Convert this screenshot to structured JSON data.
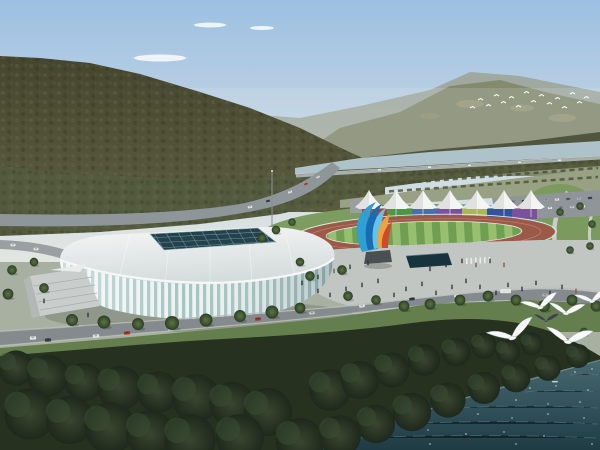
{
  "scene": {
    "title": "Aerial rendering of a riverside sports complex",
    "time_of_day": "day",
    "elements": [
      "forested mountain",
      "distant hazy ridge",
      "river",
      "orchard tree band",
      "athletics track",
      "rainbow panel grandstand wall",
      "white canopy tents",
      "parking lot",
      "ribbon flame sculpture",
      "glass lattice stadium",
      "reflecting pool",
      "plaza with pedestrians",
      "tree-lined boulevard",
      "dense riverfront forest",
      "dark green water",
      "white birds"
    ]
  },
  "colors": {
    "sky_top": "#9cc0e2",
    "sky_mid": "#c6d6e4",
    "sky_horizon": "#e3e6e1",
    "far_ridge": "#9aa08e",
    "near_ridge": "#848a6e",
    "hill_top": "#45462f",
    "hill_bottom": "#5b5c3f",
    "tree_band": "#545a3e",
    "orchard_ground": "#98a183",
    "river": "#adc2c9",
    "lawn": "#7d9c60",
    "lawn_right": "#7a9a5e",
    "track": "#9c5948",
    "field_light": "#98bf70",
    "field_dark": "#6f9f52",
    "tent": "#f3f5f3",
    "parking": "#8f9598",
    "road": "#848a8d",
    "plaza": "#c2c6c3",
    "pool": "#17333c",
    "skylight": "#24424c",
    "stadium_glass": "#a3c6c3",
    "stadium_rib": "#eef2f1",
    "grass": "#647f4d",
    "forest": "#26321f",
    "water_top": "#476870",
    "water_deep": "#1f3c45",
    "bird": "#f8faf9"
  },
  "panels": {
    "colors": [
      "#b0443a",
      "#4f9447",
      "#4a6fae",
      "#7b519d",
      "#aab84e",
      "#31539b",
      "#7b519d"
    ]
  },
  "counts": {
    "tent_canopies": 7,
    "panel_segments": 7,
    "foreground_birds": 6,
    "distant_flock_birds": 16
  }
}
